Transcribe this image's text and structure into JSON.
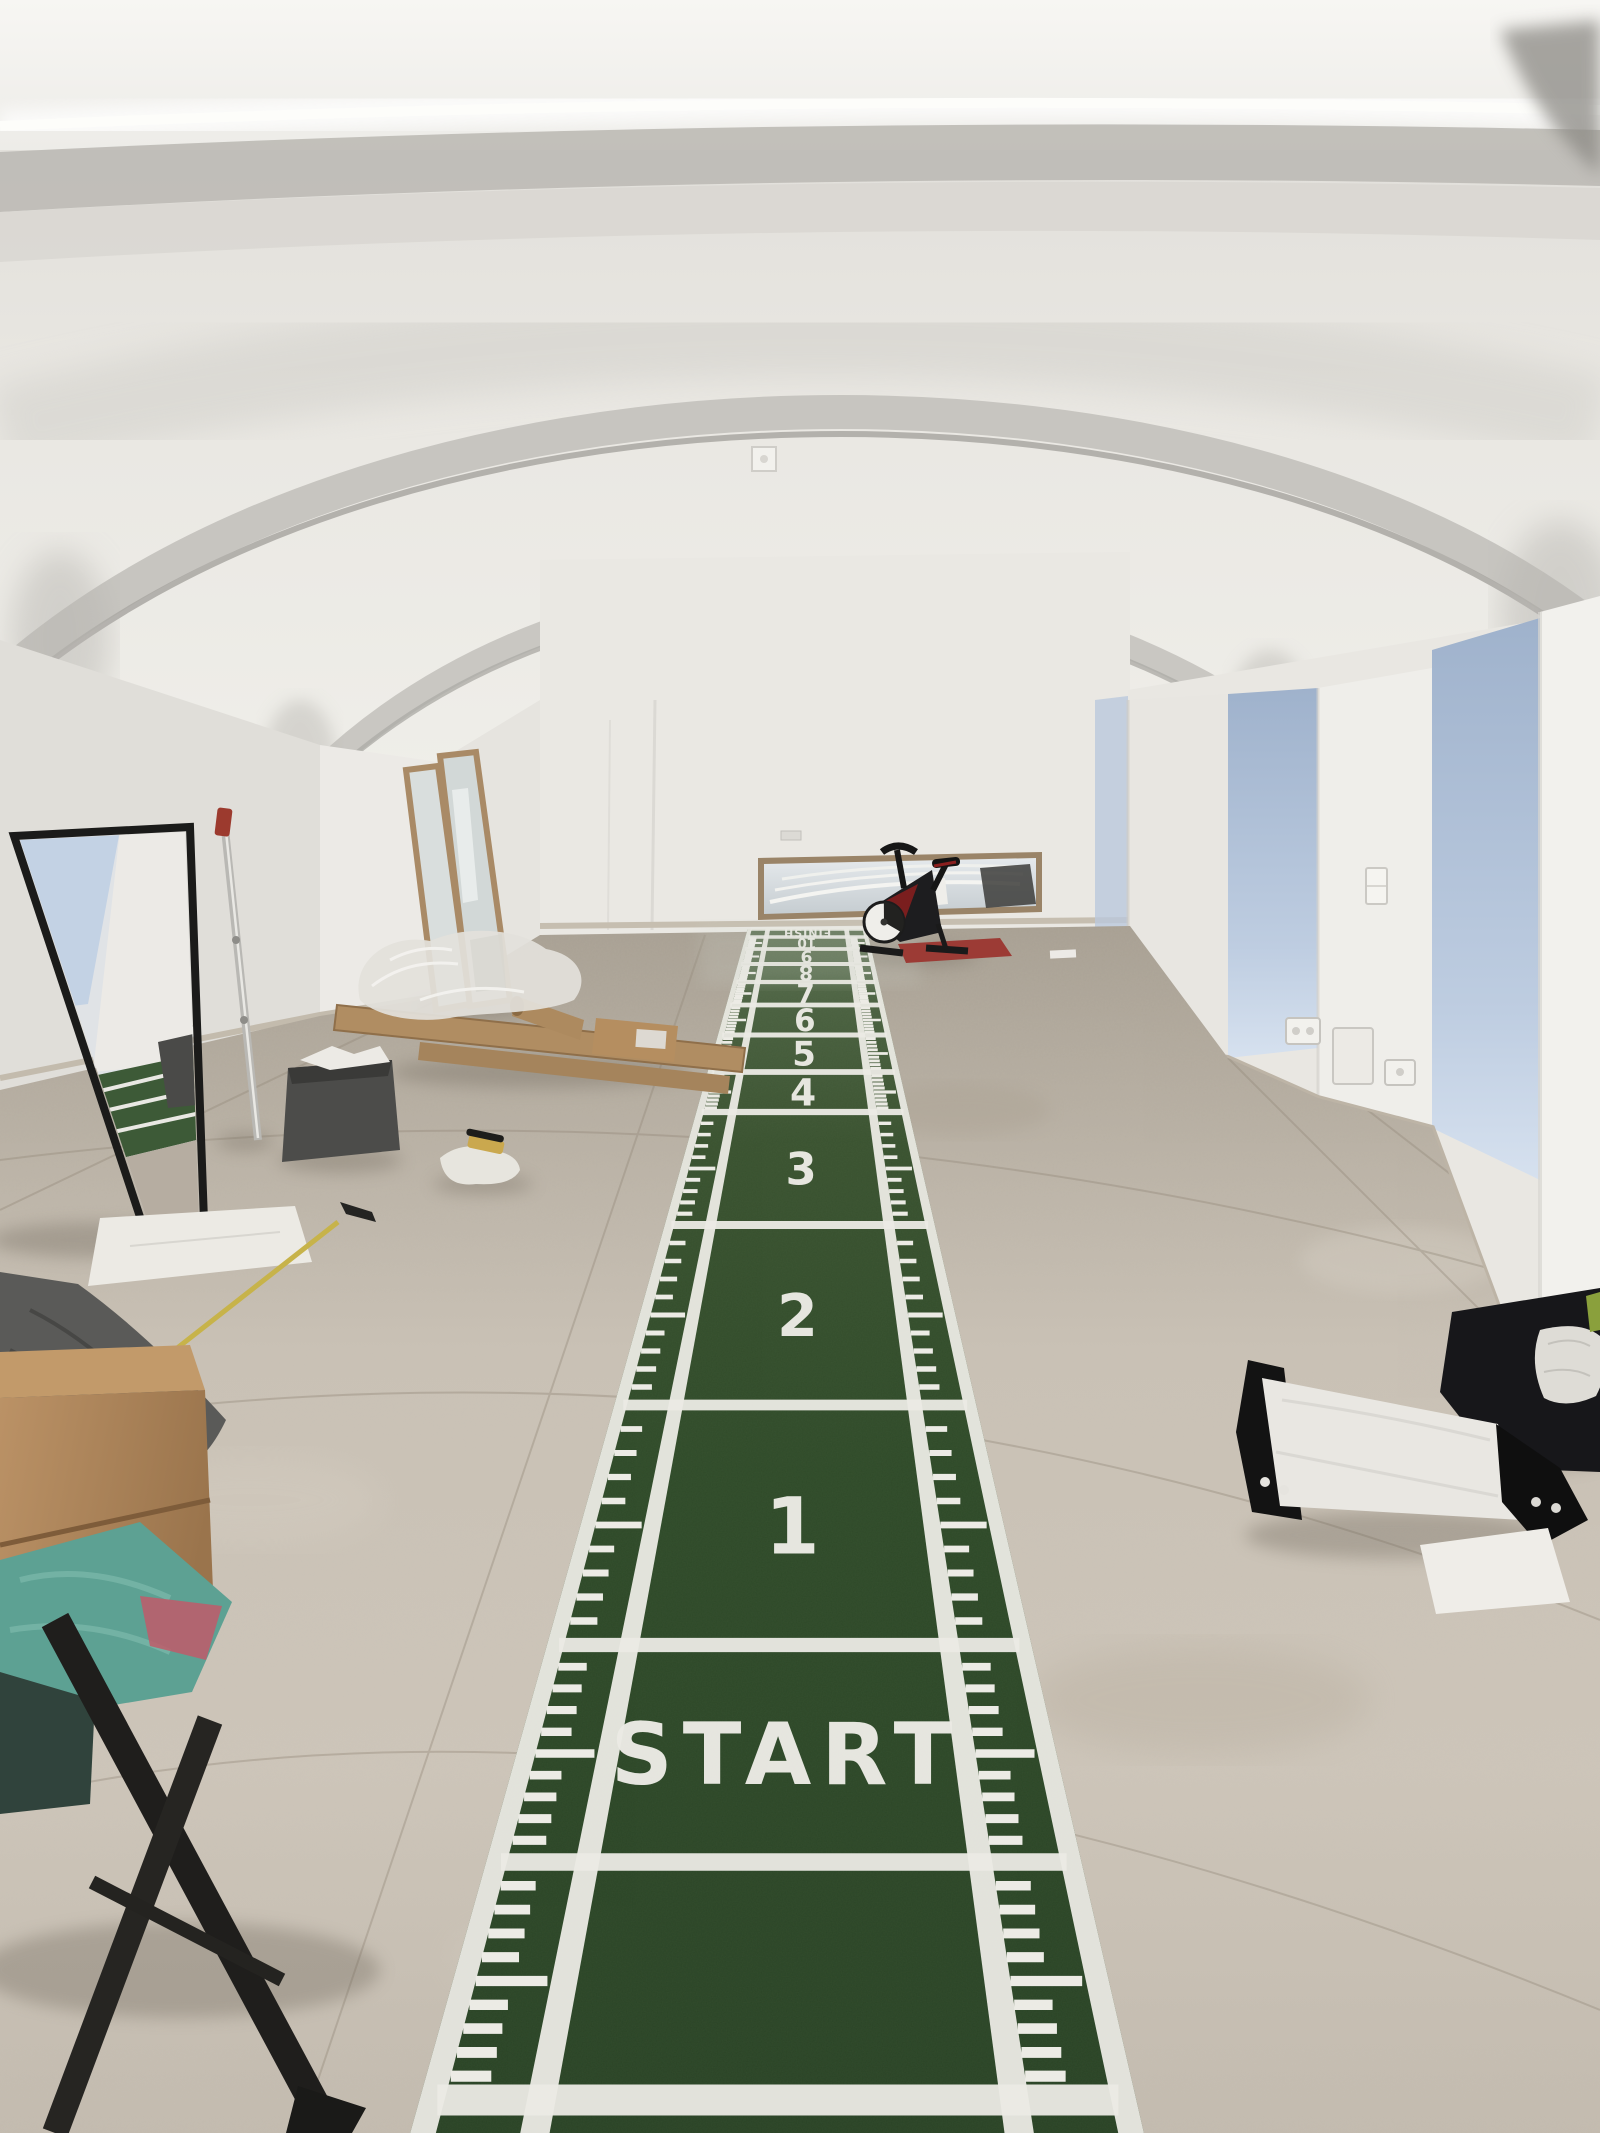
{
  "scene": {
    "description": "Basement gym under construction: vaulted white ceiling with LED strip, long green sprint-track turf mat with numbered metre boxes, spin bike, leaning mirrors and packing material",
    "room": {
      "ceiling": "white groin vaults with LED cove light",
      "wall_color": "#e9e7e2",
      "floor": "grey stone-look tiles",
      "daylight_color": "#b6c7dd"
    },
    "track": {
      "start_label": "START",
      "finish_label": "FINISH",
      "segment_numbers": [
        "1",
        "2",
        "3",
        "4",
        "5",
        "6",
        "7",
        "8",
        "9",
        "10"
      ],
      "turf_color": "#2e4a2a",
      "marking_color": "#ecebe5"
    },
    "equipment": {
      "spin_bike": {
        "frame_color": "#1a1a1a",
        "accent_color": "#7a1e1e",
        "floor_mat_color": "#9c3b35"
      }
    },
    "objects": [
      {
        "label": "black-frame-leaning-mirror"
      },
      {
        "label": "wood-frame-leaning-mirrors"
      },
      {
        "label": "horizontal-mirror-back-wall"
      },
      {
        "label": "grey-fabric-storage-bin"
      },
      {
        "label": "cardboard-boxes-and-tube"
      },
      {
        "label": "plastic-wrap-bundle"
      },
      {
        "label": "white-wrapped-package-black-caps"
      },
      {
        "label": "black-duffel-bag"
      },
      {
        "label": "wooden-box"
      },
      {
        "label": "teal-cloth-stool"
      },
      {
        "label": "yellow-measuring-stick"
      },
      {
        "label": "white-paper-sheets"
      },
      {
        "label": "chrome-pole-stand"
      }
    ]
  }
}
